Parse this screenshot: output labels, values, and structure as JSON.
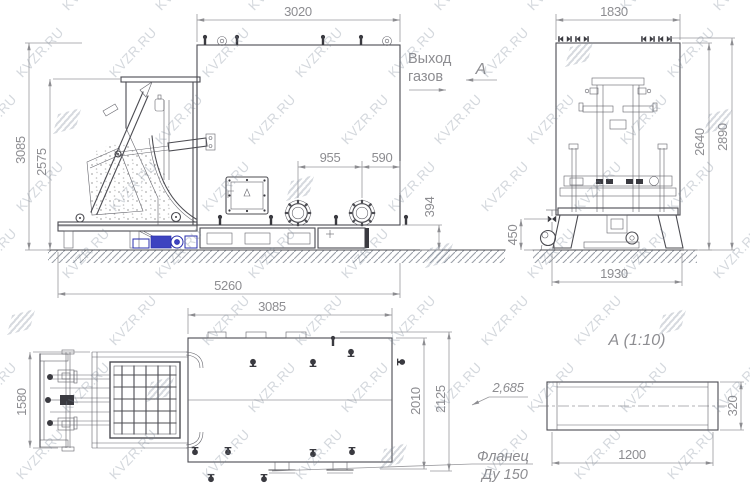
{
  "watermark": {
    "text": "KVZR.RU"
  },
  "colors": {
    "line": "#4c4c52",
    "dimension_gray": "#8d8d91",
    "motor_blue": "#2a2fae",
    "watermark_gray": "#7a8596"
  },
  "front_view": {
    "dim_body_width": "3020",
    "dim_overall_height": "3085",
    "dim_loader_height": "2575",
    "dim_port_spacing": "955",
    "dim_port_to_edge": "590",
    "dim_base_height": "394",
    "dim_overall_length": "5260",
    "gas_outlet_label_line1": "Выход",
    "gas_outlet_label_line2": "газов",
    "view_arrow_label": "А"
  },
  "side_view": {
    "dim_body_width": "1830",
    "dim_height_to_top": "2640",
    "dim_overall_height": "2890",
    "dim_fan_height": "450",
    "dim_base_width": "1930"
  },
  "plan_view": {
    "dim_body_length": "3085",
    "dim_loader_width": "1580",
    "dim_body_depth": "2010",
    "dim_overall_depth": "2125",
    "mass_label": "2,685",
    "flange_label_line1": "Фланец",
    "flange_label_line2": "Ду 150"
  },
  "detail_view": {
    "title": "А  (1:10)",
    "dim_length": "1200",
    "dim_height": "320"
  }
}
